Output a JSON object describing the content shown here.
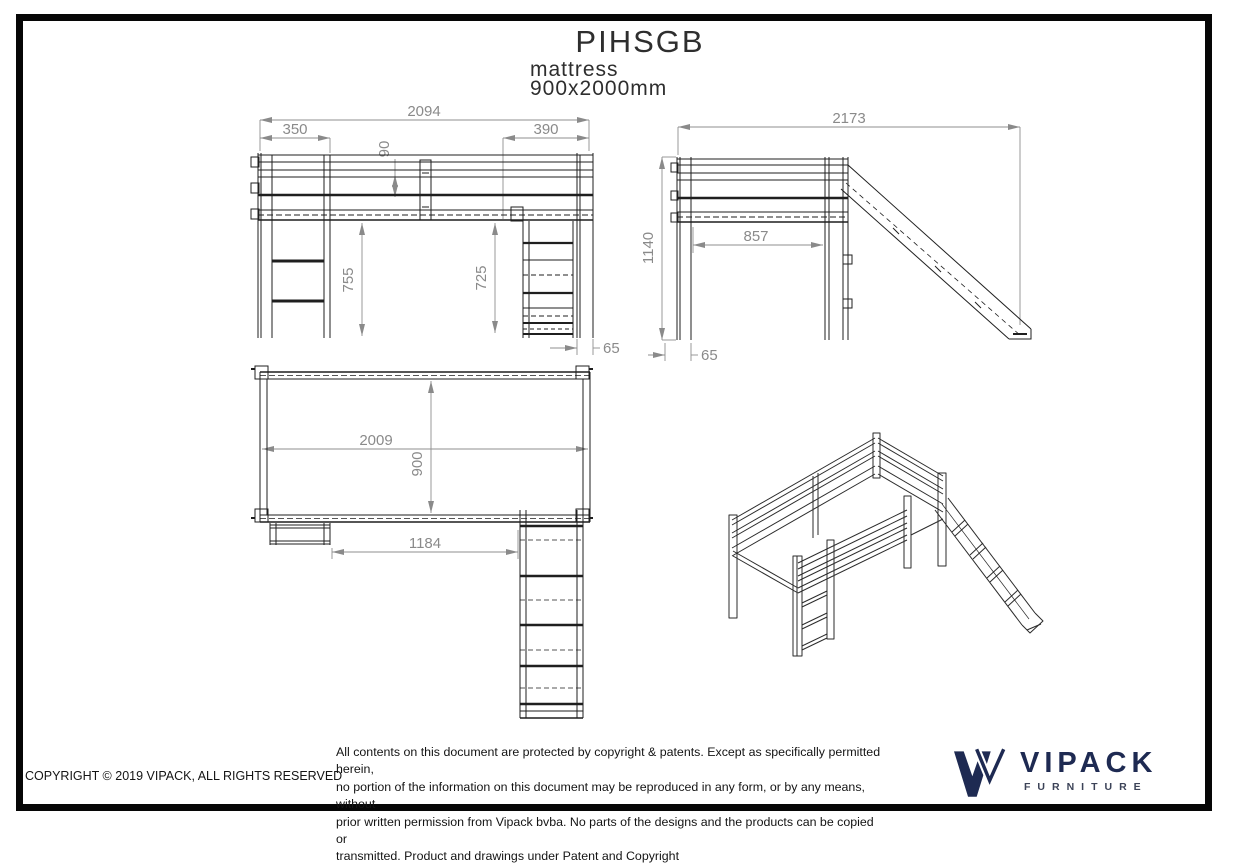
{
  "header": {
    "title": "PIHSGB",
    "subtitle": "mattress",
    "mattress_size": "900x2000mm"
  },
  "views": {
    "front": {
      "dims": {
        "overall_width": "2094",
        "ladder_section": "350",
        "rail_gap": "90",
        "slide_section": "390",
        "clearance_left": "755",
        "clearance_right": "725",
        "post_width": "65"
      }
    },
    "side": {
      "dims": {
        "overall_depth": "2173",
        "overall_height": "1140",
        "inner_depth": "857",
        "post_depth": "65"
      }
    },
    "plan": {
      "dims": {
        "bed_length": "2009",
        "bed_width": "900",
        "ladder_to_slide": "1184"
      }
    }
  },
  "footer": {
    "copyright": "COPYRIGHT  © 2019 VIPACK, ALL RIGHTS RESERVED",
    "legal_lines": [
      "All contents on this document are protected by copyright & patents. Except as specifically permitted herein,",
      "no portion of the information on this document may be reproduced in any form, or by any means, without",
      "prior written permission from Vipack bvba. No parts of the designs and the products can be copied or",
      "transmitted. Product and drawings under Patent and Copyright"
    ]
  },
  "logo": {
    "brand": "VIPACK",
    "tagline": "FURNITURE",
    "brand_color": "#1e2a52"
  }
}
